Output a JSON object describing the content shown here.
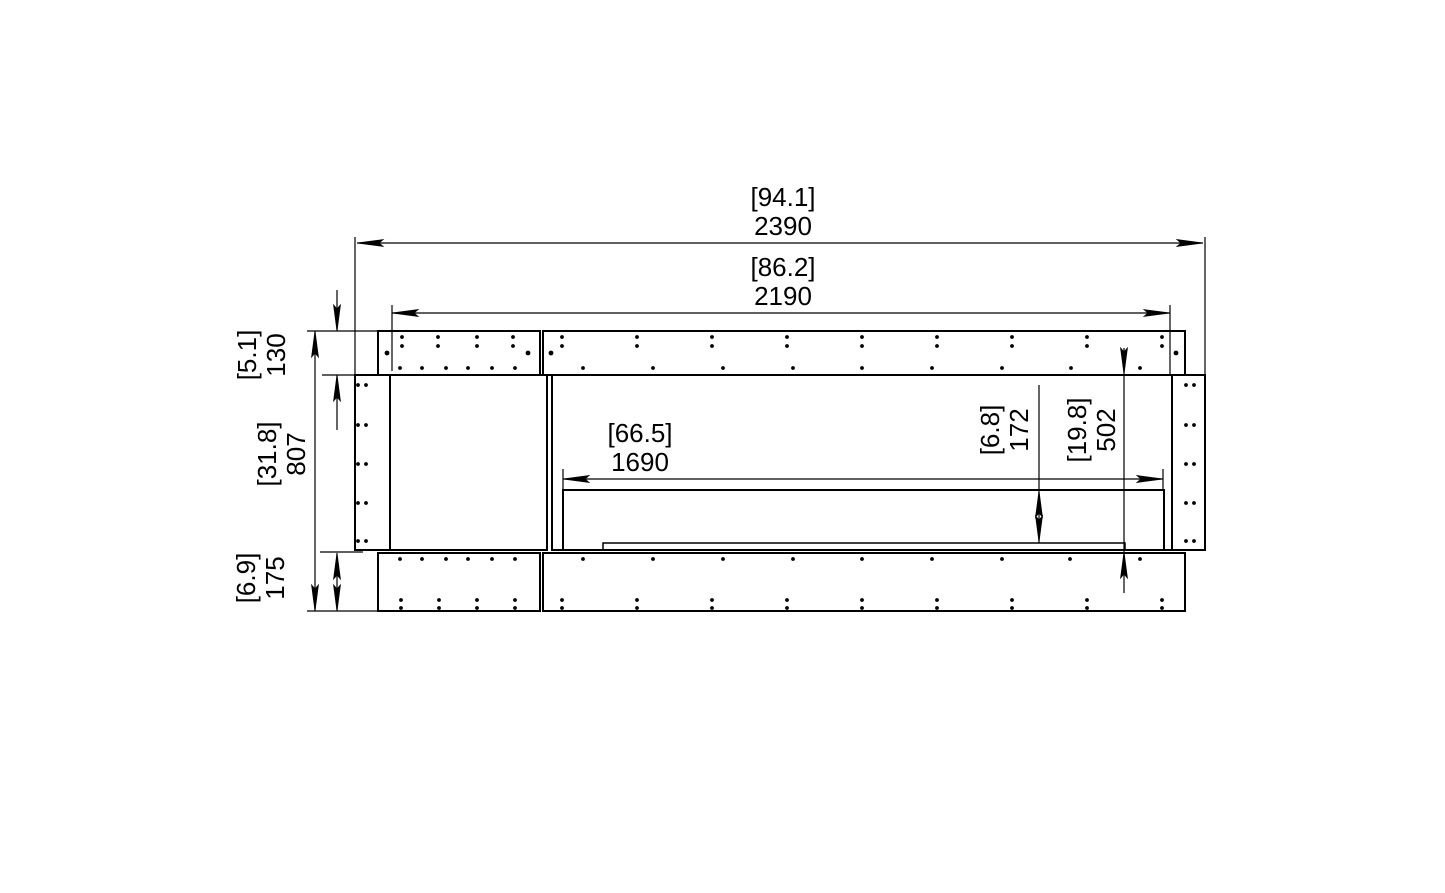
{
  "drawing": {
    "type": "technical-dimension-drawing",
    "description": "Front elevation line drawing of a wide fireplace cabinet with top panel, base panel, side panels, left blank cabinet section and right firebox opening with burner tray. Dimensions given in mm with inches in brackets.",
    "background": "#ffffff",
    "line_color": "#000000"
  },
  "dims": {
    "overall_width": {
      "inches": "[94.1]",
      "mm": "2390"
    },
    "internal_width": {
      "inches": "[86.2]",
      "mm": "2190"
    },
    "firebox_width": {
      "inches": "[66.5]",
      "mm": "1690"
    },
    "top_panel_height": {
      "inches": "[5.1]",
      "mm": "130"
    },
    "overall_height": {
      "inches": "[31.8]",
      "mm": "807"
    },
    "base_height": {
      "inches": "[6.9]",
      "mm": "175"
    },
    "opening_height": {
      "inches": "[6.8]",
      "mm": "172"
    },
    "body_height": {
      "inches": "[19.8]",
      "mm": "502"
    }
  },
  "geometry": {
    "rects": [
      {
        "name": "top-panel-left",
        "x": 378,
        "y": 331,
        "w": 162,
        "h": 44,
        "sw": 2
      },
      {
        "name": "top-panel-right",
        "x": 543,
        "y": 331,
        "w": 642,
        "h": 44,
        "sw": 2
      },
      {
        "name": "side-panel-left",
        "x": 355,
        "y": 375,
        "w": 35,
        "h": 175,
        "sw": 2
      },
      {
        "name": "cabinet-section",
        "x": 390,
        "y": 375,
        "w": 157,
        "h": 175,
        "sw": 2
      },
      {
        "name": "firebox-section",
        "x": 552,
        "y": 375,
        "w": 620,
        "h": 175,
        "sw": 2
      },
      {
        "name": "side-panel-right",
        "x": 1172,
        "y": 375,
        "w": 33,
        "h": 175,
        "sw": 2
      },
      {
        "name": "bottom-panel-left",
        "x": 378,
        "y": 553,
        "w": 162,
        "h": 58,
        "sw": 2
      },
      {
        "name": "bottom-panel-right",
        "x": 543,
        "y": 553,
        "w": 642,
        "h": 58,
        "sw": 2
      },
      {
        "name": "firebox-opening",
        "x": 563,
        "y": 490,
        "w": 601,
        "h": 60,
        "sw": 2
      },
      {
        "name": "burner-tray",
        "x": 603,
        "y": 543,
        "w": 522,
        "h": 7,
        "sw": 1.5
      }
    ],
    "lines": [
      {
        "name": "dim-line-2390",
        "x1": 357,
        "y1": 243,
        "x2": 1203,
        "y2": 243
      },
      {
        "name": "dim-line-2190",
        "x1": 392,
        "y1": 313,
        "x2": 1170,
        "y2": 313
      },
      {
        "name": "dim-line-1690",
        "x1": 563,
        "y1": 479,
        "x2": 1163,
        "y2": 479
      },
      {
        "name": "dim-line-807",
        "x1": 315,
        "y1": 331,
        "x2": 315,
        "y2": 611
      },
      {
        "name": "dim-line-130-upper",
        "x1": 337,
        "y1": 290,
        "x2": 337,
        "y2": 331
      },
      {
        "name": "dim-line-130-lower",
        "x1": 337,
        "y1": 375,
        "x2": 337,
        "y2": 430
      },
      {
        "name": "dim-line-175",
        "x1": 337,
        "y1": 553,
        "x2": 337,
        "y2": 611
      },
      {
        "name": "dim-line-502",
        "x1": 1124,
        "y1": 348,
        "x2": 1124,
        "y2": 593
      },
      {
        "name": "dim-line-172",
        "x1": 1039,
        "y1": 385,
        "x2": 1039,
        "y2": 543
      },
      {
        "name": "ext-line-2390-left",
        "x1": 355,
        "y1": 237,
        "x2": 355,
        "y2": 374
      },
      {
        "name": "ext-line-2390-right",
        "x1": 1205,
        "y1": 237,
        "x2": 1205,
        "y2": 374
      },
      {
        "name": "ext-line-2190-left",
        "x1": 392,
        "y1": 305,
        "x2": 392,
        "y2": 371
      },
      {
        "name": "ext-line-2190-right",
        "x1": 1170,
        "y1": 305,
        "x2": 1170,
        "y2": 374
      },
      {
        "name": "tick-1690-left",
        "x1": 563,
        "y1": 469,
        "x2": 563,
        "y2": 489
      },
      {
        "name": "tick-1690-right",
        "x1": 1163,
        "y1": 469,
        "x2": 1163,
        "y2": 489
      },
      {
        "name": "ext-line-top",
        "x1": 307,
        "y1": 331,
        "x2": 377,
        "y2": 331
      },
      {
        "name": "ext-line-body-top",
        "x1": 322,
        "y1": 375,
        "x2": 363,
        "y2": 375
      },
      {
        "name": "ext-line-base-top",
        "x1": 320,
        "y1": 552,
        "x2": 363,
        "y2": 552
      },
      {
        "name": "ext-line-bottom",
        "x1": 307,
        "y1": 611,
        "x2": 377,
        "y2": 611
      }
    ],
    "arrows": [
      {
        "x": 357,
        "y": 243,
        "dir": "left"
      },
      {
        "x": 1203,
        "y": 243,
        "dir": "right"
      },
      {
        "x": 392,
        "y": 313,
        "dir": "left"
      },
      {
        "x": 1170,
        "y": 313,
        "dir": "right"
      },
      {
        "x": 563,
        "y": 479,
        "dir": "left"
      },
      {
        "x": 1163,
        "y": 479,
        "dir": "right"
      },
      {
        "x": 315,
        "y": 331,
        "dir": "up"
      },
      {
        "x": 315,
        "y": 611,
        "dir": "down"
      },
      {
        "x": 337,
        "y": 331,
        "dir": "down"
      },
      {
        "x": 337,
        "y": 375,
        "dir": "up"
      },
      {
        "x": 337,
        "y": 553,
        "dir": "up"
      },
      {
        "x": 337,
        "y": 611,
        "dir": "down"
      },
      {
        "x": 1124,
        "y": 374,
        "dir": "down"
      },
      {
        "x": 1124,
        "y": 552,
        "dir": "up"
      },
      {
        "x": 1039,
        "y": 491,
        "dir": "up"
      },
      {
        "x": 1039,
        "y": 542,
        "dir": "down"
      }
    ],
    "dot_groups": [
      {
        "name": "top-panel-left-hole-pairs",
        "xs": [
          402,
          438,
          477,
          513
        ],
        "ys": [
          337,
          346
        ]
      },
      {
        "name": "top-panel-left-mid-holes",
        "xs": [
          387,
          528
        ],
        "ys": [
          353
        ],
        "r": 2.4
      },
      {
        "name": "top-panel-left-bottom-holes",
        "xs": [
          400,
          422,
          446,
          468,
          492,
          515
        ],
        "ys": [
          368
        ]
      },
      {
        "name": "top-panel-right-hole-pairs",
        "xs": [
          562,
          637,
          712,
          787,
          862,
          937,
          1012,
          1087,
          1162
        ],
        "ys": [
          337,
          346
        ]
      },
      {
        "name": "top-panel-right-mid-holes",
        "xs": [
          551,
          1176
        ],
        "ys": [
          353
        ],
        "r": 2.4
      },
      {
        "name": "top-panel-right-bottom-holes",
        "xs": [
          583,
          653,
          723,
          793,
          862,
          932,
          1002,
          1071,
          1140
        ],
        "ys": [
          368
        ]
      },
      {
        "name": "bottom-panel-left-top-holes",
        "xs": [
          400,
          422,
          446,
          468,
          492,
          515
        ],
        "ys": [
          559
        ]
      },
      {
        "name": "bottom-panel-left-hole-pairs",
        "xs": [
          401,
          439,
          477,
          515
        ],
        "ys": [
          600,
          608
        ]
      },
      {
        "name": "bottom-panel-right-top-holes",
        "xs": [
          583,
          653,
          723,
          793,
          862,
          932,
          1002,
          1070,
          1140
        ],
        "ys": [
          559
        ]
      },
      {
        "name": "bottom-panel-right-hole-pairs",
        "xs": [
          562,
          637,
          712,
          787,
          862,
          937,
          1012,
          1087,
          1162
        ],
        "ys": [
          600,
          608
        ]
      },
      {
        "name": "side-panel-left-hole-pairs",
        "xs": [
          358,
          366
        ],
        "ys": [
          385,
          425,
          464,
          503,
          541
        ]
      },
      {
        "name": "side-panel-right-hole-pairs",
        "xs": [
          1186,
          1194
        ],
        "ys": [
          385,
          425,
          464,
          503,
          541
        ]
      }
    ]
  }
}
